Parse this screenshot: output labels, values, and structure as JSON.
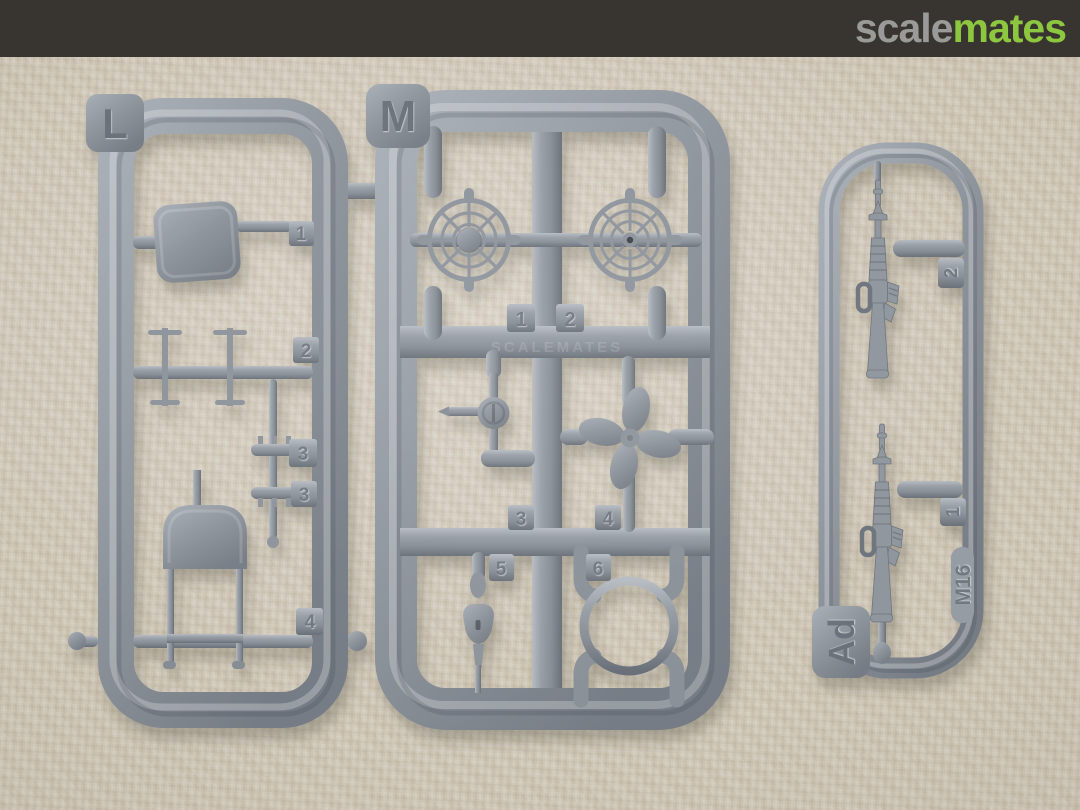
{
  "header": {
    "background_color": "#383430",
    "logo_scale": "scale",
    "logo_mates": "mates",
    "logo_scale_color": "#9a9a98",
    "logo_mates_color": "#8dc63f"
  },
  "photo": {
    "background_color": "#cfc6b6",
    "plastic_color": "#8d939b",
    "watermark": "SCALEMATES"
  },
  "sprue_l": {
    "label": "L",
    "tabs": [
      "1",
      "2",
      "3",
      "3",
      "4"
    ]
  },
  "sprue_m": {
    "label": "M",
    "tabs": [
      "1",
      "2",
      "3",
      "4",
      "5",
      "6"
    ]
  },
  "sprue_ad": {
    "label": "Ad",
    "marking": "M16",
    "tabs": [
      "2",
      "1"
    ]
  }
}
